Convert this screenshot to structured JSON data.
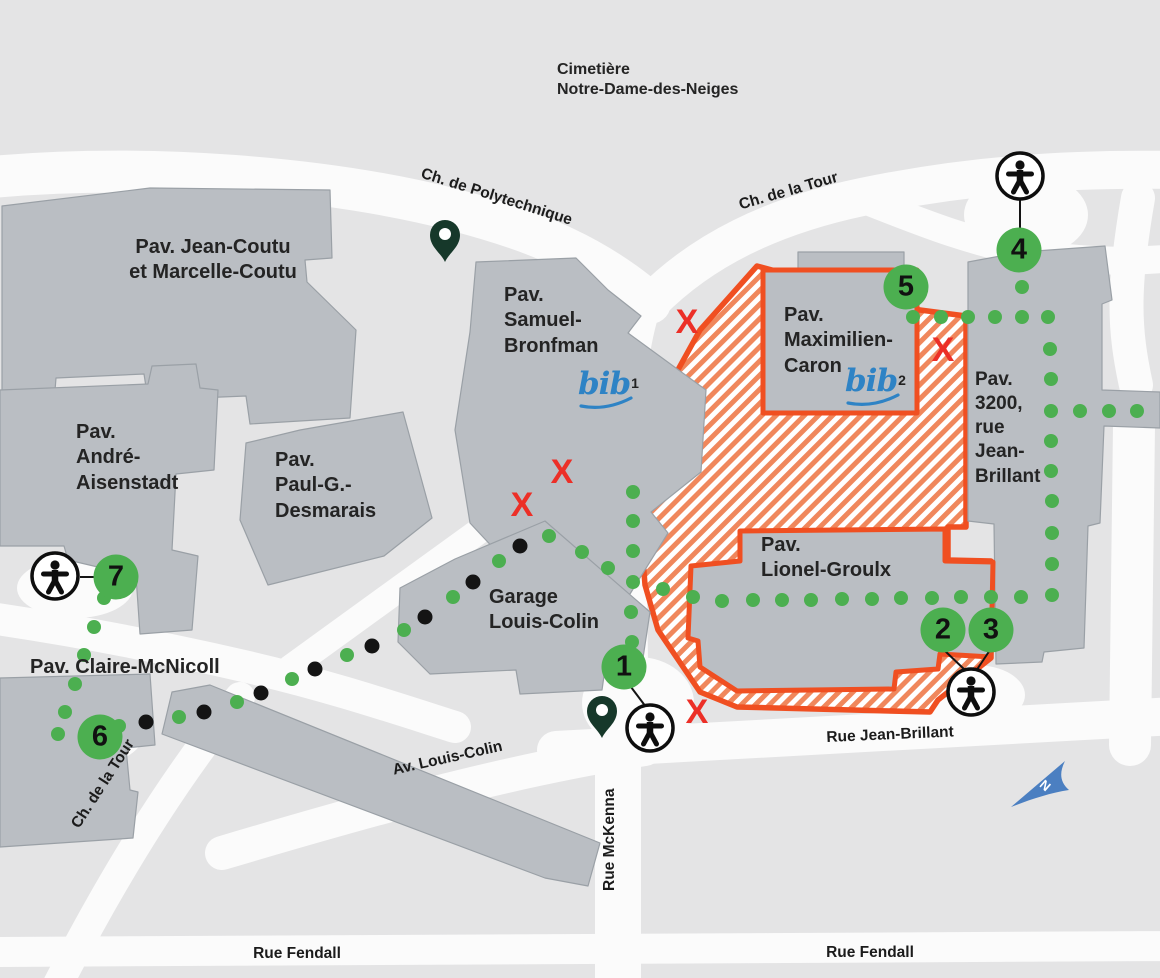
{
  "map_name": "campus-accessibility-map",
  "colors": {
    "background": "#e4e4e5",
    "street": "#fbfbfb",
    "building_fill": "#babec3",
    "building_stroke": "#9aa0a6",
    "route_green": "#4caf50",
    "route_black": "#141414",
    "closed_red": "#ec2f27",
    "zone_border": "#f04f21",
    "zone_hatch": "#f0875c",
    "pin_dark_green": "#16382a",
    "north_blue": "#4b7fc1",
    "bib_blue": "#2e83c5",
    "label": "#242424"
  },
  "region_labels": {
    "cemetery": "Cimetière\nNotre-Dame-des-Neiges"
  },
  "buildings": [
    {
      "id": "jean-coutu",
      "label": "Pav. Jean-Coutu\net Marcelle-Coutu"
    },
    {
      "id": "andre-aisenstadt",
      "label": "Pav.\nAndré-\nAisenstadt"
    },
    {
      "id": "paul-g-desmarais",
      "label": "Pav.\nPaul-G.-\nDesmarais"
    },
    {
      "id": "samuel-bronfman",
      "label": "Pav.\nSamuel-\nBronfman",
      "library": {
        "text": "bib",
        "sup": "1"
      }
    },
    {
      "id": "maximilien-caron",
      "label": "Pav.\nMaximilien-\nCaron",
      "library": {
        "text": "bib",
        "sup": "2"
      }
    },
    {
      "id": "pav-3200-jean-brillant",
      "label": "Pav.\n3200,\nrue\nJean-\nBrillant"
    },
    {
      "id": "lionel-groulx",
      "label": "Pav.\nLionel-Groulx"
    },
    {
      "id": "garage-louis-colin",
      "label": "Garage\nLouis-Colin"
    },
    {
      "id": "claire-mcnicoll",
      "label": "Pav. Claire-McNicoll"
    }
  ],
  "streets": [
    {
      "id": "ch-de-polytechnique",
      "label": "Ch. de Polytechnique"
    },
    {
      "id": "ch-de-la-tour-nord",
      "label": "Ch. de la Tour"
    },
    {
      "id": "ch-de-la-tour-sud",
      "label": "Ch. de la Tour"
    },
    {
      "id": "rue-jean-brillant",
      "label": "Rue Jean-Brillant"
    },
    {
      "id": "av-louis-colin",
      "label": "Av. Louis-Colin"
    },
    {
      "id": "rue-mckenna",
      "label": "Rue McKenna"
    },
    {
      "id": "rue-fendall-ouest",
      "label": "Rue Fendall"
    },
    {
      "id": "rue-fendall-est",
      "label": "Rue Fendall"
    }
  ],
  "markers": [
    {
      "number": "1",
      "x": 624,
      "y": 667
    },
    {
      "number": "2",
      "x": 943,
      "y": 630
    },
    {
      "number": "3",
      "x": 991,
      "y": 630
    },
    {
      "number": "4",
      "x": 1019,
      "y": 250
    },
    {
      "number": "5",
      "x": 906,
      "y": 287
    },
    {
      "number": "6",
      "x": 100,
      "y": 737
    },
    {
      "number": "7",
      "x": 116,
      "y": 577
    }
  ],
  "accessibility_icons": [
    {
      "x": 1020,
      "y": 176
    },
    {
      "x": 971,
      "y": 692
    },
    {
      "x": 650,
      "y": 728
    },
    {
      "x": 55,
      "y": 576
    }
  ],
  "closed_marks": {
    "glyph": "X",
    "positions": [
      [
        687,
        322
      ],
      [
        943,
        350
      ],
      [
        562,
        472
      ],
      [
        522,
        505
      ],
      [
        697,
        712
      ]
    ]
  },
  "pins": [
    {
      "x": 445,
      "y": 262
    },
    {
      "x": 602,
      "y": 738
    }
  ],
  "dot_paths": [
    {
      "id": "ridge-path-6-to-garage",
      "dots": [
        [
          119,
          726,
          "g"
        ],
        [
          146,
          722,
          "k"
        ],
        [
          179,
          717,
          "g"
        ],
        [
          204,
          712,
          "k"
        ],
        [
          237,
          702,
          "g"
        ],
        [
          261,
          693,
          "k"
        ],
        [
          292,
          679,
          "g"
        ],
        [
          315,
          669,
          "k"
        ],
        [
          347,
          655,
          "g"
        ],
        [
          372,
          646,
          "k"
        ],
        [
          404,
          630,
          "g"
        ],
        [
          425,
          617,
          "k"
        ],
        [
          453,
          597,
          "g"
        ],
        [
          473,
          582,
          "k"
        ],
        [
          499,
          561,
          "g"
        ],
        [
          520,
          546,
          "k"
        ],
        [
          549,
          536,
          "g"
        ],
        [
          582,
          552,
          "g"
        ],
        [
          608,
          568,
          "g"
        ]
      ]
    },
    {
      "id": "path-to-marker-1",
      "dots": [
        [
          633,
          492,
          "g"
        ],
        [
          633,
          521,
          "g"
        ],
        [
          633,
          551,
          "g"
        ],
        [
          633,
          582,
          "g"
        ],
        [
          631,
          612,
          "g"
        ],
        [
          632,
          642,
          "g"
        ]
      ]
    },
    {
      "id": "path-from-marker-7",
      "dots": [
        [
          104,
          598,
          "g"
        ],
        [
          94,
          627,
          "g"
        ],
        [
          84,
          655,
          "g"
        ],
        [
          75,
          684,
          "g"
        ],
        [
          65,
          712,
          "g"
        ],
        [
          58,
          734,
          "g"
        ]
      ]
    },
    {
      "id": "path-marker-5-to-4",
      "dots": [
        [
          1022,
          287,
          "g"
        ],
        [
          913,
          317,
          "g"
        ],
        [
          941,
          317,
          "g"
        ],
        [
          968,
          317,
          "g"
        ],
        [
          995,
          317,
          "g"
        ],
        [
          1022,
          317,
          "g"
        ],
        [
          1048,
          317,
          "g"
        ]
      ]
    },
    {
      "id": "path-3200-interior",
      "dots": [
        [
          1050,
          349,
          "g"
        ],
        [
          1051,
          379,
          "g"
        ],
        [
          1051,
          411,
          "g"
        ],
        [
          1051,
          441,
          "g"
        ],
        [
          1051,
          471,
          "g"
        ],
        [
          1052,
          501,
          "g"
        ],
        [
          1052,
          533,
          "g"
        ],
        [
          1052,
          564,
          "g"
        ],
        [
          1052,
          595,
          "g"
        ]
      ]
    },
    {
      "id": "path-3200-east-branch",
      "dots": [
        [
          1080,
          411,
          "g"
        ],
        [
          1109,
          411,
          "g"
        ],
        [
          1137,
          411,
          "g"
        ]
      ]
    },
    {
      "id": "path-lionel-groulx",
      "dots": [
        [
          663,
          589,
          "g"
        ],
        [
          693,
          597,
          "g"
        ],
        [
          722,
          601,
          "g"
        ],
        [
          753,
          600,
          "g"
        ],
        [
          782,
          600,
          "g"
        ],
        [
          811,
          600,
          "g"
        ],
        [
          842,
          599,
          "g"
        ],
        [
          872,
          599,
          "g"
        ],
        [
          901,
          598,
          "g"
        ],
        [
          932,
          598,
          "g"
        ],
        [
          961,
          597,
          "g"
        ],
        [
          991,
          597,
          "g"
        ],
        [
          1021,
          597,
          "g"
        ]
      ]
    }
  ],
  "north_arrow": {
    "label": "N"
  }
}
